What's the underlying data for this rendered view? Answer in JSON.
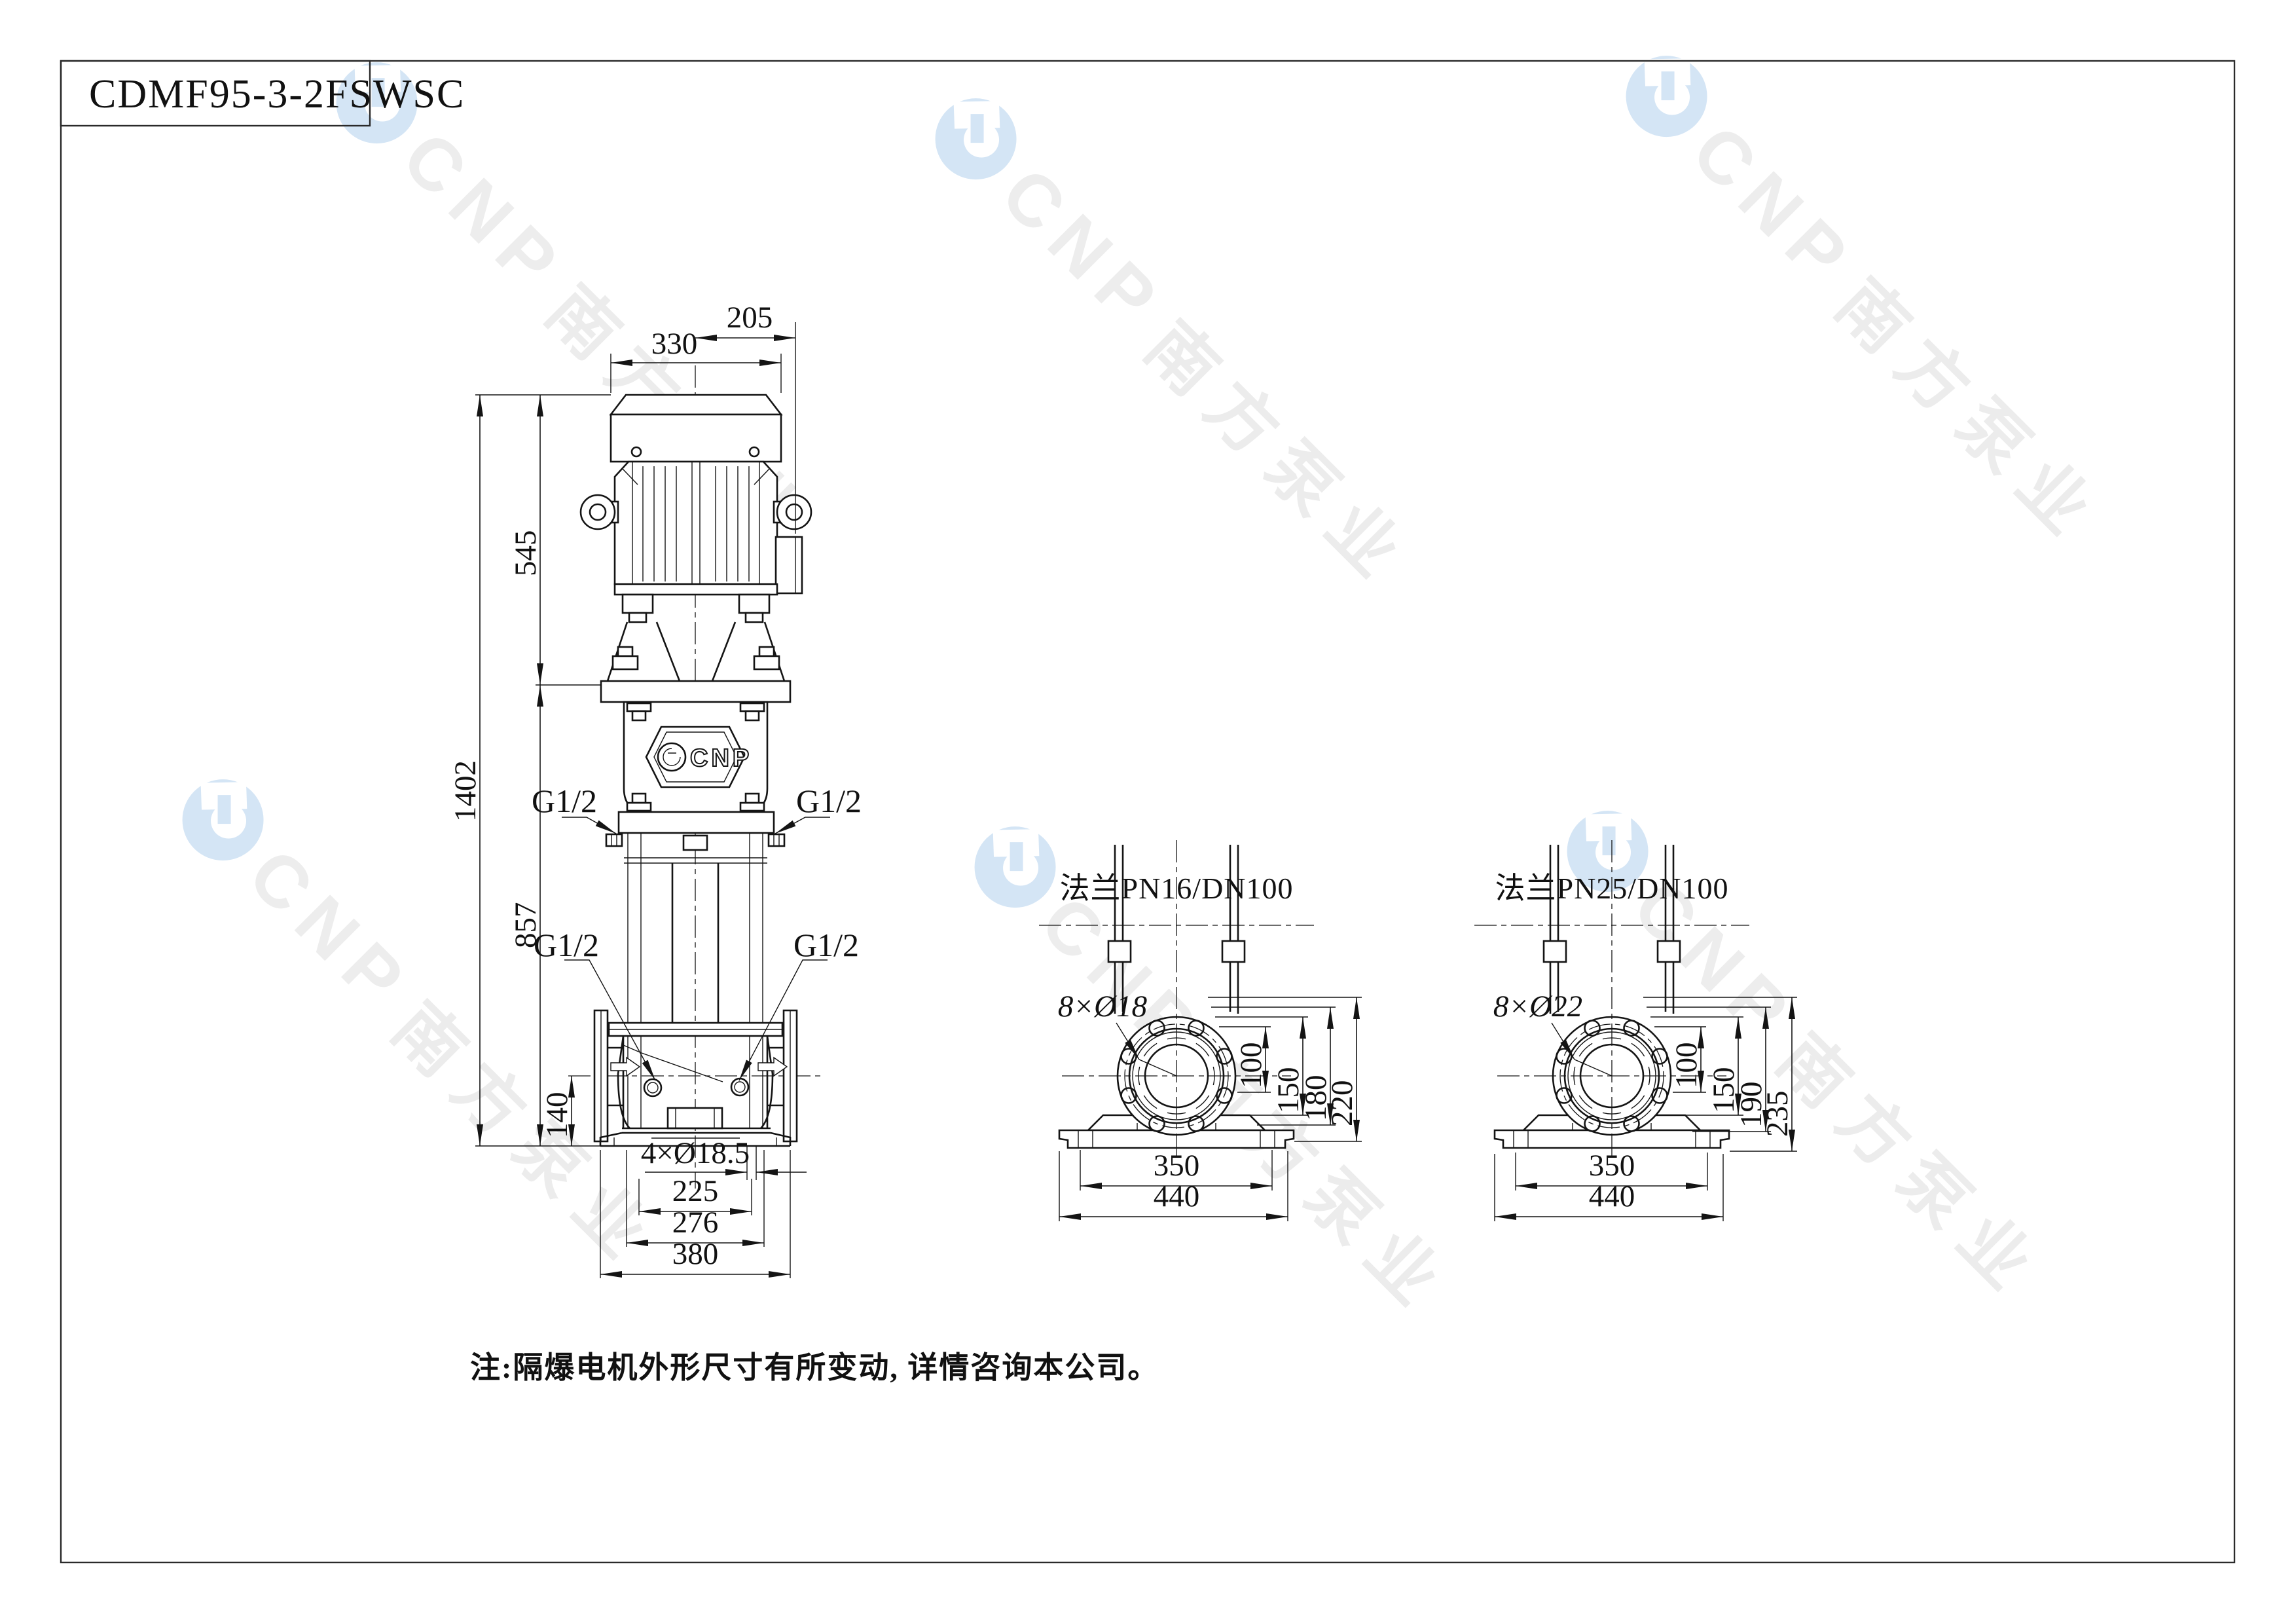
{
  "title": {
    "drawing_number": "CDMF95-3-2FSWSC"
  },
  "watermark": {
    "cnp": "CNP",
    "brand": "南方泵业"
  },
  "front_view": {
    "logo": "CNP",
    "dims": {
      "w330": "330",
      "w205": "205",
      "h545": "545",
      "h1402": "1402",
      "h857": "857",
      "h140": "140",
      "holes": "4×Ø18.5",
      "s225": "225",
      "s276": "276",
      "s380": "380"
    },
    "ports": {
      "upper_left": "G1/2",
      "upper_right": "G1/2",
      "lower_left": "G1/2",
      "lower_right": "G1/2"
    }
  },
  "flange_pn16": {
    "label": "法兰PN16/DN100",
    "holes": "8×Ø18",
    "dims": {
      "d100": "100",
      "d150": "150",
      "d180": "180",
      "d220": "220",
      "w350": "350",
      "w440": "440"
    }
  },
  "flange_pn25": {
    "label": "法兰PN25/DN100",
    "holes": "8×Ø22",
    "dims": {
      "d100": "100",
      "d150": "150",
      "d190": "190",
      "d235": "235",
      "w350": "350",
      "w440": "440"
    }
  },
  "note": "注:隔爆电机外形尺寸有所变动, 详情咨询本公司。"
}
